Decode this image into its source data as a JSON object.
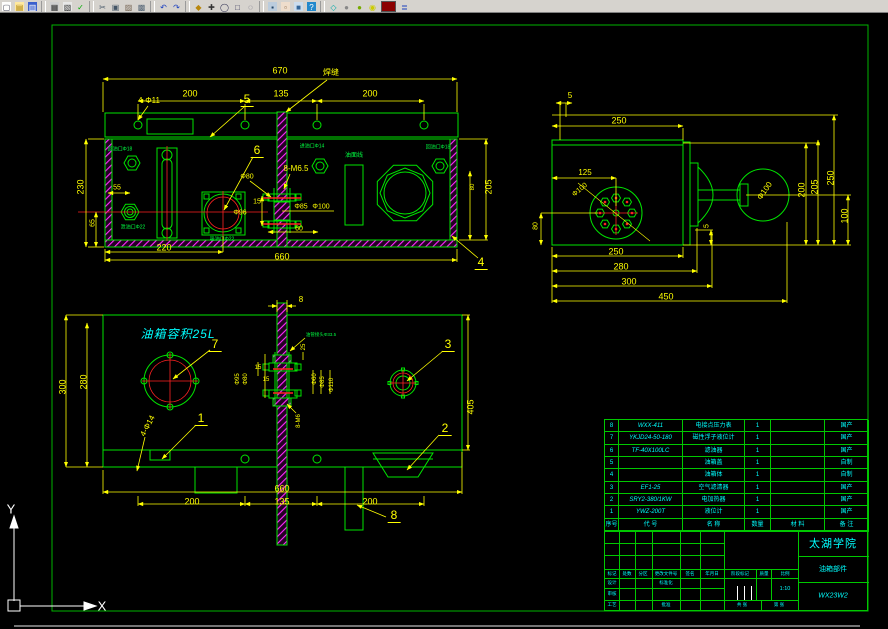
{
  "colors": {
    "geometry_green": "#00e500",
    "dim_yellow": "#ffff00",
    "hatch_magenta": "#ff2bff",
    "centerline_red": "#ff2222",
    "note_cyan": "#00ffff",
    "frame_green": "#00b400",
    "toolbar_gray": "#d6d3ce"
  },
  "toolbar": {
    "icons": [
      {
        "n": "new-file-icon",
        "g": "▢"
      },
      {
        "n": "open-file-icon",
        "g": "▤"
      },
      {
        "n": "save-icon",
        "g": "▥"
      },
      {
        "n": "plot-icon",
        "g": "▦"
      },
      {
        "n": "plot-preview-icon",
        "g": "▧"
      },
      {
        "n": "spell-icon",
        "g": "✓"
      },
      {
        "n": "cut-icon",
        "g": "✂"
      },
      {
        "n": "copy-icon",
        "g": "▣"
      },
      {
        "n": "paste-icon",
        "g": "▨"
      },
      {
        "n": "match-properties-icon",
        "g": "▩"
      },
      {
        "n": "undo-icon",
        "g": "↶"
      },
      {
        "n": "redo-icon",
        "g": "↷"
      },
      {
        "n": "insert-hyperlink-icon",
        "g": "◆"
      },
      {
        "n": "pan-icon",
        "g": "✚"
      },
      {
        "n": "zoom-realtime-icon",
        "g": "◯"
      },
      {
        "n": "zoom-window-icon",
        "g": "□"
      },
      {
        "n": "zoom-previous-icon",
        "g": "◌"
      },
      {
        "n": "properties-icon",
        "g": "▪"
      },
      {
        "n": "design-center-icon",
        "g": "▫"
      },
      {
        "n": "tool-palettes-icon",
        "g": "■"
      },
      {
        "n": "help-icon",
        "g": "?"
      },
      {
        "n": "ucs-icon-toggle",
        "g": "◇"
      },
      {
        "n": "named-views-icon",
        "g": "●"
      },
      {
        "n": "shade-icon",
        "g": "●"
      },
      {
        "n": "orbit-icon",
        "g": "◉"
      },
      {
        "n": "text-style-icon",
        "g": "≣"
      }
    ]
  },
  "tv": {
    "d670": "670",
    "d200a": "200",
    "d135": "135",
    "d200b": "200",
    "dphi11": "4-Φ11",
    "b5": "5",
    "weld": "焊缝",
    "d230": "230",
    "d65": "65",
    "d55": "55",
    "d220": "220",
    "d660": "660",
    "d205": "205",
    "d80": "80",
    "b6": "6",
    "b4": "4",
    "m65": "8-M6.5",
    "phi80": "Φ80",
    "d15": "15",
    "phi96": "Φ96",
    "phi85": "Φ85",
    "phi100": "Φ100",
    "d60": "60",
    "port_tl": "回油口Φ18",
    "port_l": "泄油口Φ22",
    "port_sq": "吸油口Φ22",
    "port_mid": "进油口Φ14",
    "port_tr": "回油口Φ18",
    "oil_line": "油面线"
  },
  "sv": {
    "d5a": "5",
    "d250t": "250",
    "d125": "125",
    "phi100a": "Φ100",
    "d80": "80",
    "phi100b": "Φ100",
    "d200": "200",
    "d205": "205",
    "d250r": "250",
    "d100": "100",
    "d5b": "5",
    "d250b": "250",
    "d280": "280",
    "d300": "300",
    "d450": "450"
  },
  "fv": {
    "d8": "8",
    "cap": "油箱容积25L",
    "b7": "7",
    "b3": "3",
    "b1": "1",
    "b2": "2",
    "b8": "8",
    "phi14": "4-Φ14",
    "note": "油管接头Φ33.5",
    "d300": "300",
    "d280": "280",
    "d405": "405",
    "phi95": "Φ95",
    "phi80": "Φ80",
    "d15a": "15",
    "d15b": "15",
    "d25": "25",
    "phi60": "Φ60",
    "phi85": "Φ85",
    "phi110": "Φ110",
    "m6": "8-M6",
    "d660": "660",
    "d200a": "200",
    "d135": "135",
    "d200b": "200"
  },
  "pt": {
    "h": [
      "序号",
      "代 号",
      "名 称",
      "数量",
      "材 料",
      "备 注"
    ],
    "rows": [
      [
        "8",
        "WXX-411",
        "电接点压力表",
        "1",
        "",
        "国产"
      ],
      [
        "7",
        "YKJD24-50-180",
        "磁性浮子液位计",
        "1",
        "",
        "国产"
      ],
      [
        "6",
        "TF-40X100LC",
        "滤油器",
        "1",
        "",
        "国产"
      ],
      [
        "5",
        "",
        "油箱盖",
        "1",
        "",
        "自制"
      ],
      [
        "4",
        "",
        "油箱体",
        "1",
        "",
        "自制"
      ],
      [
        "3",
        "EF1-25",
        "空气滤清器",
        "1",
        "",
        "国产"
      ],
      [
        "2",
        "SRY2-380/1KW",
        "电加热器",
        "1",
        "",
        "国产"
      ],
      [
        "1",
        "YWZ-200T",
        "液位计",
        "1",
        "",
        "国产"
      ]
    ]
  },
  "tb": {
    "school": "太湖学院",
    "part": "油箱部件",
    "number": "WX23W2",
    "scale": "1:10",
    "cols": [
      "标记",
      "处数",
      "分区",
      "更改文件号",
      "签名",
      "年月日"
    ],
    "design": "设计",
    "standard": "标准化",
    "check": "审核",
    "craft": "工艺",
    "approve": "批准",
    "stage": [
      "阶段标记",
      "质量",
      "比例"
    ],
    "sheet_total": "共 张",
    "sheet_no": "第 张"
  },
  "ucs": {
    "x": "X",
    "y": "Y"
  }
}
